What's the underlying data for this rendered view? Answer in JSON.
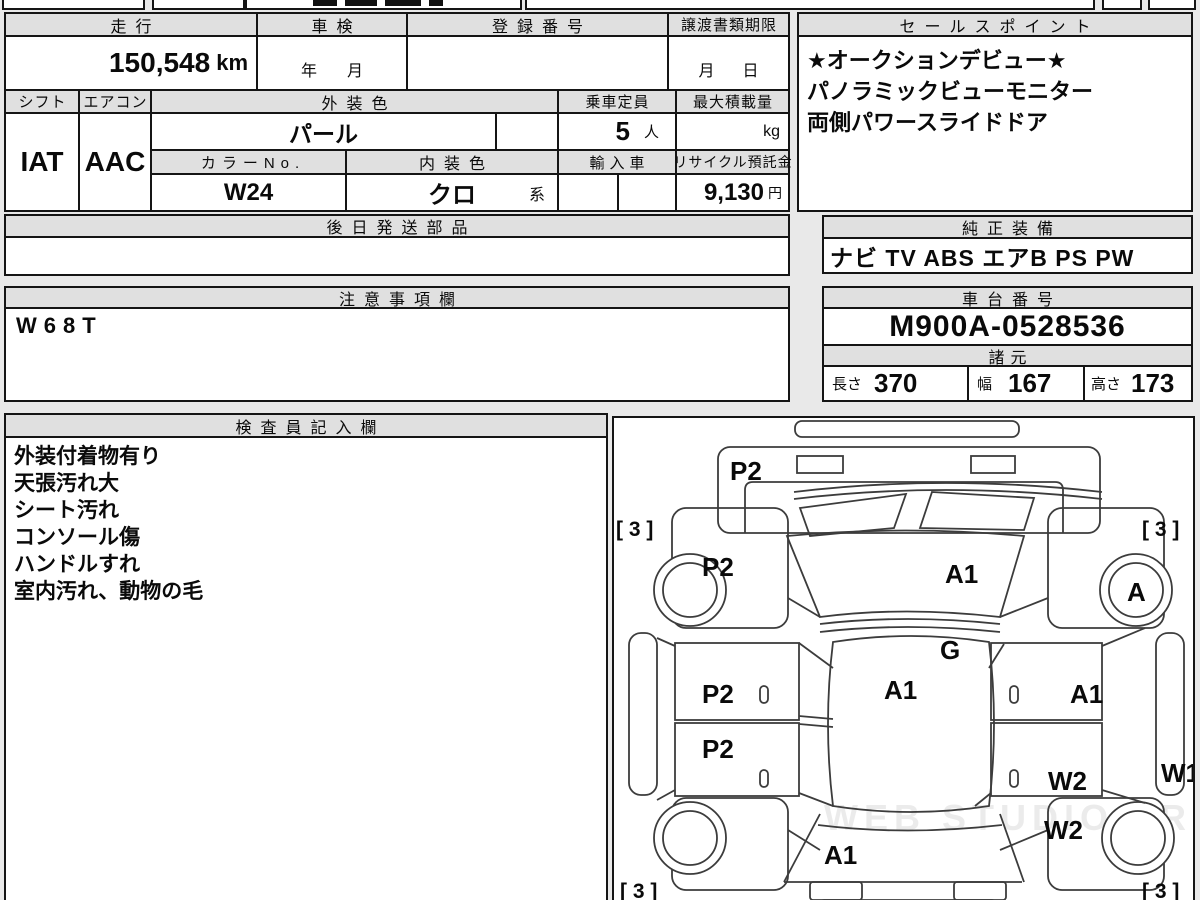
{
  "page": {
    "watermark": "WEB STUDIO PRO"
  },
  "info": {
    "mileage": {
      "label": "走行",
      "value": "150,548",
      "unit": "km"
    },
    "inspection": {
      "label": "車検",
      "year_label": "年",
      "month_label": "月"
    },
    "registration": {
      "label": "登録番号",
      "value": ""
    },
    "transfer_deadline": {
      "label": "譲渡書類期限",
      "month_label": "月",
      "day_label": "日"
    },
    "shift": {
      "label": "シフト",
      "value": "IAT"
    },
    "aircon": {
      "label": "エアコン",
      "value": "AAC"
    },
    "exterior_color": {
      "label": "外装色",
      "value": "パール"
    },
    "capacity": {
      "label": "乗車定員",
      "value": "5",
      "unit": "人"
    },
    "max_load": {
      "label": "最大積載量",
      "value": "",
      "unit": "kg"
    },
    "color_no": {
      "label": "カラーNo.",
      "value": "W24"
    },
    "interior_color": {
      "label": "内装色",
      "value": "クロ",
      "suffix": "系"
    },
    "import_car": {
      "label": "輸入車",
      "value": ""
    },
    "recycle_deposit": {
      "label": "リサイクル預託金",
      "value": "9,130",
      "unit": "円"
    },
    "later_parts": {
      "label": "後日発送部品",
      "value": ""
    }
  },
  "sales_points": {
    "label": "セールスポイント",
    "lines": [
      "★オークションデビュー★",
      "パノラミックビューモニター",
      "両側パワースライドドア"
    ]
  },
  "equipment": {
    "label": "純正装備",
    "value": "ナビ TV ABS エアB PS PW"
  },
  "notes": {
    "label": "注意事項欄",
    "value": "W68T"
  },
  "chassis": {
    "label": "車台番号",
    "value": "M900A-0528536"
  },
  "specs": {
    "label": "諸元",
    "length_label": "長さ",
    "length": "370",
    "width_label": "幅",
    "width": "167",
    "height_label": "高さ",
    "height": "173"
  },
  "inspector": {
    "label": "検査員記入欄",
    "lines": [
      "外装付着物有り",
      "天張汚れ大",
      "シート汚れ",
      "コンソール傷",
      "ハンドルすれ",
      "室内汚れ、動物の毛"
    ]
  },
  "diagram": {
    "labels": [
      {
        "part": "front-bumper",
        "text": "P2"
      },
      {
        "part": "corner-front-left",
        "text": "[ 3 ]"
      },
      {
        "part": "corner-front-right",
        "text": "[ 3 ]"
      },
      {
        "part": "fender-front-left",
        "text": "P2"
      },
      {
        "part": "windshield",
        "text": "A1"
      },
      {
        "part": "wheel-front-right",
        "text": "A"
      },
      {
        "part": "cowl",
        "text": "G"
      },
      {
        "part": "roof",
        "text": "A1"
      },
      {
        "part": "door-front-left",
        "text": "P2"
      },
      {
        "part": "door-rear-left",
        "text": "P2"
      },
      {
        "part": "door-front-right",
        "text": "A1"
      },
      {
        "part": "door-rear-right",
        "text": "W2"
      },
      {
        "part": "sill-right",
        "text": "W1"
      },
      {
        "part": "fender-rear-right",
        "text": "W2"
      },
      {
        "part": "rear-gate",
        "text": "A1"
      },
      {
        "part": "corner-rear-left",
        "text": "[ 3 ]"
      },
      {
        "part": "corner-rear-right",
        "text": "[ 3 ]"
      }
    ]
  }
}
